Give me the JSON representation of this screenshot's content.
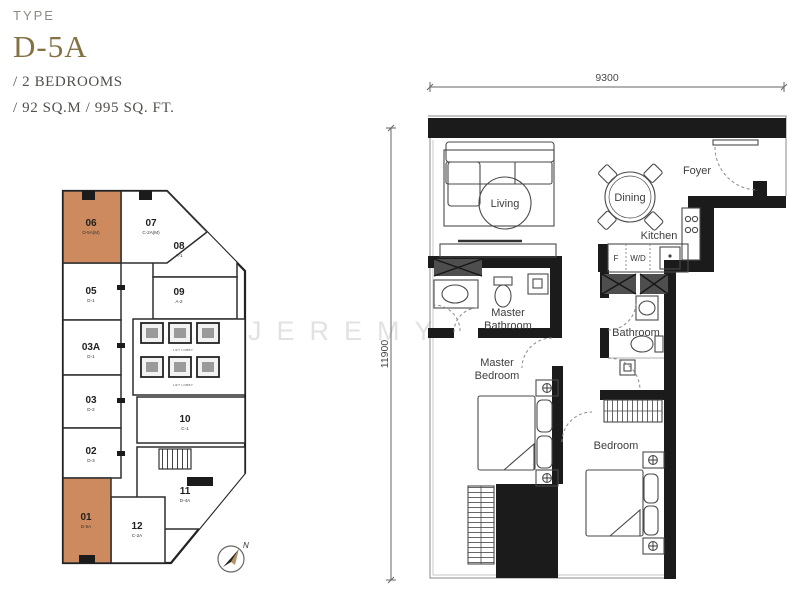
{
  "header": {
    "type_label": "TYPE",
    "type_value": "D-5A",
    "specs": [
      "/ 2 BEDROOMS",
      "/ 92 SQ.M / 995 SQ. FT."
    ]
  },
  "watermark": "JEREMY",
  "colors": {
    "highlight_orange": "#cd8a5e",
    "title_gold": "#857243"
  },
  "key_plan": {
    "units": [
      {
        "no": "06",
        "code": "D-5A(M)",
        "highlighted": true
      },
      {
        "no": "07",
        "code": "C-2A(M)",
        "highlighted": false
      },
      {
        "no": "08",
        "code": "A-1",
        "highlighted": false
      },
      {
        "no": "09",
        "code": "A-2",
        "highlighted": false
      },
      {
        "no": "05",
        "code": "D-1",
        "highlighted": false
      },
      {
        "no": "03A",
        "code": "D-1",
        "highlighted": false
      },
      {
        "no": "03",
        "code": "D-2",
        "highlighted": false
      },
      {
        "no": "02",
        "code": "D-3",
        "highlighted": false
      },
      {
        "no": "10",
        "code": "C-1",
        "highlighted": false
      },
      {
        "no": "11",
        "code": "D-4A",
        "highlighted": false
      },
      {
        "no": "01",
        "code": "D-5A",
        "highlighted": true
      },
      {
        "no": "12",
        "code": "C-2A",
        "highlighted": false
      }
    ],
    "lift_lobby_labels": [
      "LIFT LOBBY",
      "LIFT LOBBY"
    ],
    "compass": "N"
  },
  "floor_plan": {
    "dim_width": "9300",
    "dim_height": "11900",
    "rooms": {
      "living": "Living",
      "dining": "Dining",
      "foyer": "Foyer",
      "kitchen": "Kitchen",
      "master_bathroom_line1": "Master",
      "master_bathroom_line2": "Bathroom",
      "master_bedroom_line1": "Master",
      "master_bedroom_line2": "Bedroom",
      "bathroom": "Bathroom",
      "bedroom": "Bedroom",
      "fridge": "F",
      "washer_dryer": "W/D"
    }
  }
}
